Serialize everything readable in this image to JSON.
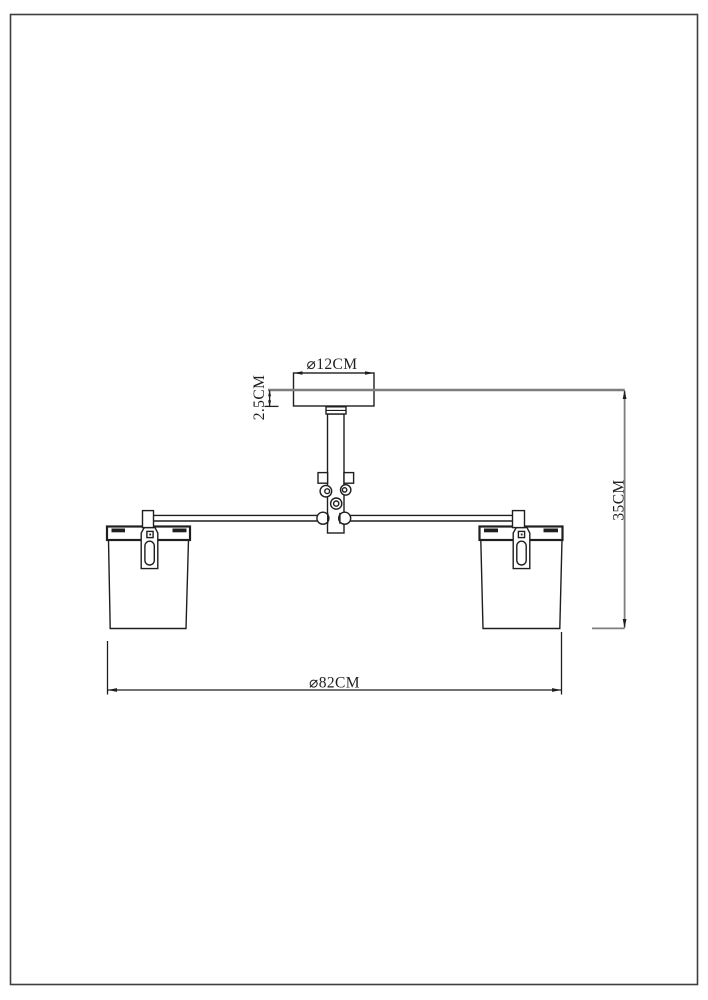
{
  "drawing": {
    "labels": {
      "canopy_diameter": "⌀12CM",
      "canopy_height": "2.5CM",
      "overall_height": "35CM",
      "overall_diameter": "⌀82CM"
    },
    "colors": {
      "ink": "#1f1f1f",
      "guide": "#7e7e7e",
      "border": "#3f3f3f",
      "paper": "#ffffff"
    }
  }
}
